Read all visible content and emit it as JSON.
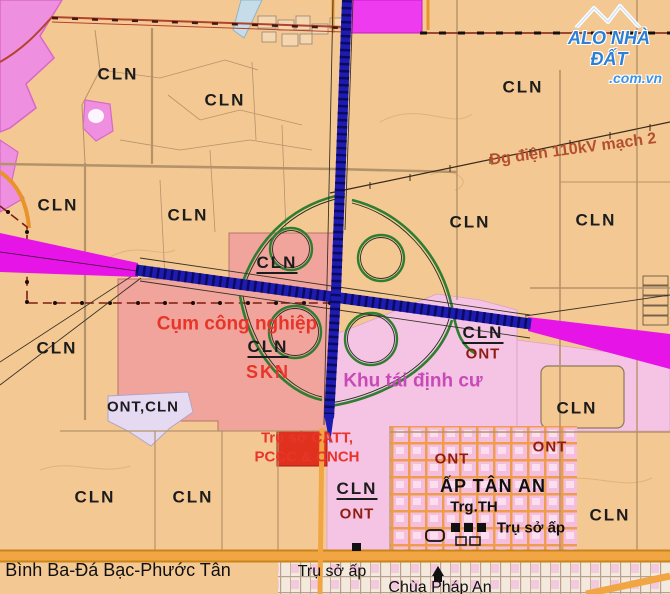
{
  "logo": {
    "line1": "ALO NHÀ ĐẤT",
    "line2": ".com.vn"
  },
  "colors": {
    "land_agri": "#f3c893",
    "industrial_zone": "#f0a49b",
    "resettlement_zone": "#f5c4e4",
    "magenta_patch": "#ee8fe0",
    "planned_road_magenta": "#e714e7",
    "highway_navy": "#1d1bb0",
    "ramp_green": "#2f7e2f",
    "road_orange": "#f1a643",
    "boundary_dark_red": "#7d1d12",
    "label_red": "#e8352a",
    "label_dark_red": "#8e1c10",
    "label_magenta": "#c84ab8",
    "logo_blue": "#2e7fd6",
    "office_red_box": "#e0301e"
  },
  "labels": [
    {
      "n": "zone-label-cln",
      "t": "CLN",
      "x": 118,
      "y": 74,
      "c": "zone"
    },
    {
      "n": "zone-label-cln",
      "t": "CLN",
      "x": 225,
      "y": 100,
      "c": "zone"
    },
    {
      "n": "zone-label-cln",
      "t": "CLN",
      "x": 523,
      "y": 87,
      "c": "zone"
    },
    {
      "n": "zone-label-cln",
      "t": "CLN",
      "x": 58,
      "y": 205,
      "c": "zone"
    },
    {
      "n": "zone-label-cln",
      "t": "CLN",
      "x": 188,
      "y": 215,
      "c": "zone"
    },
    {
      "n": "zone-label-cln",
      "t": "CLN",
      "x": 470,
      "y": 222,
      "c": "zone"
    },
    {
      "n": "zone-label-cln",
      "t": "CLN",
      "x": 596,
      "y": 220,
      "c": "zone"
    },
    {
      "n": "zone-label-cln",
      "t": "CLN",
      "x": 57,
      "y": 348,
      "c": "zone"
    },
    {
      "n": "zone-label-cln",
      "t": "CLN",
      "x": 577,
      "y": 408,
      "c": "zone"
    },
    {
      "n": "zone-label-cln",
      "t": "CLN",
      "x": 95,
      "y": 497,
      "c": "zone"
    },
    {
      "n": "zone-label-cln",
      "t": "CLN",
      "x": 193,
      "y": 497,
      "c": "zone"
    },
    {
      "n": "zone-label-cln",
      "t": "CLN",
      "x": 610,
      "y": 515,
      "c": "zone"
    },
    {
      "n": "zone-label-ont-cln",
      "t": "ONT,CLN",
      "x": 143,
      "y": 407,
      "c": "zone-sm"
    },
    {
      "n": "zone-label-cln-underlined",
      "t": "CLN",
      "x": 277,
      "y": 264,
      "c": "zone-u"
    },
    {
      "n": "zone-label-cln-underlined",
      "t": "CLN",
      "x": 268,
      "y": 348,
      "c": "zone-u"
    },
    {
      "n": "zone-label-skn",
      "t": "SKN",
      "x": 268,
      "y": 372,
      "c": "red-md"
    },
    {
      "n": "zone-label-cln-underlined",
      "t": "CLN",
      "x": 483,
      "y": 334,
      "c": "zone-u"
    },
    {
      "n": "zone-label-ont",
      "t": "ONT",
      "x": 483,
      "y": 354,
      "c": "darkred"
    },
    {
      "n": "zone-label-cln-underlined",
      "t": "CLN",
      "x": 357,
      "y": 490,
      "c": "zone-u"
    },
    {
      "n": "zone-label-ont",
      "t": "ONT",
      "x": 357,
      "y": 514,
      "c": "darkred"
    },
    {
      "n": "zone-label-ont",
      "t": "ONT",
      "x": 452,
      "y": 459,
      "c": "darkred"
    },
    {
      "n": "zone-label-ont",
      "t": "ONT",
      "x": 550,
      "y": 447,
      "c": "darkred"
    },
    {
      "n": "area-label-industrial",
      "t": "Cụm công nghiệp",
      "x": 237,
      "y": 324,
      "c": "red"
    },
    {
      "n": "area-label-police-hq-1",
      "t": "Trụ sở CATT,",
      "x": 307,
      "y": 438,
      "c": "red-sm"
    },
    {
      "n": "area-label-police-hq-2",
      "t": "PCCC & CNCH",
      "x": 307,
      "y": 457,
      "c": "red-sm"
    },
    {
      "n": "area-label-resettlement",
      "t": "Khu tái định cư",
      "x": 413,
      "y": 381,
      "c": "magenta"
    },
    {
      "n": "powerline-label",
      "t": "Đg điện 110kV mạch 2",
      "x": 573,
      "y": 150,
      "c": "brown",
      "r": -7.5
    },
    {
      "n": "hamlet-label",
      "t": "ẤP TÂN AN",
      "x": 493,
      "y": 486,
      "c": "black-bold"
    },
    {
      "n": "school-label",
      "t": "Trg.TH",
      "x": 474,
      "y": 507,
      "c": "black"
    },
    {
      "n": "hamlet-office-label",
      "t": "Trụ sở ấp",
      "x": 531,
      "y": 528,
      "c": "black"
    },
    {
      "n": "hamlet-office-label",
      "t": "Trụ sở ấp",
      "x": 332,
      "y": 572,
      "c": "road-sm"
    },
    {
      "n": "pagoda-label",
      "t": "Chùa Pháp An",
      "x": 440,
      "y": 588,
      "c": "road-sm"
    },
    {
      "n": "road-name-label",
      "t": "Bình Ba-Đá Bạc-Phước Tân",
      "x": 118,
      "y": 570,
      "c": "roadname"
    }
  ]
}
